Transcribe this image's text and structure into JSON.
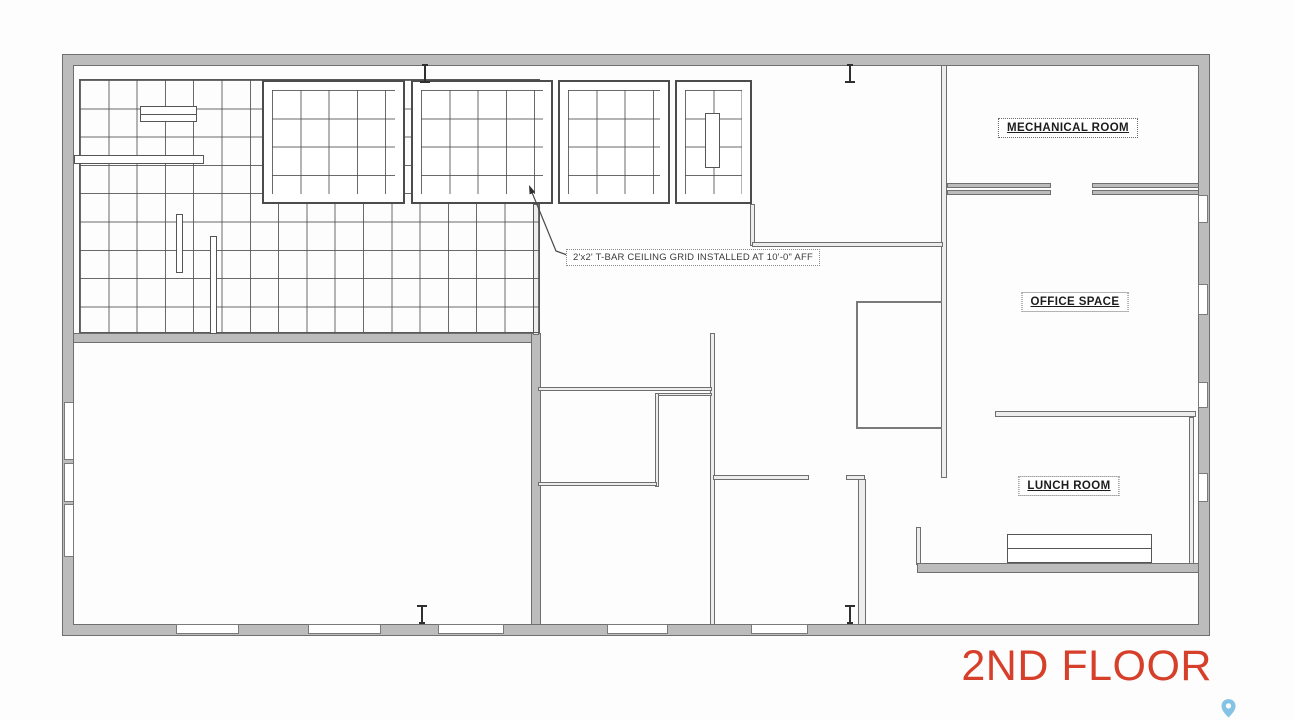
{
  "plan": {
    "title": "2ND FLOOR",
    "rooms": [
      {
        "label": "MECHANICAL ROOM"
      },
      {
        "label": "OFFICE SPACE"
      },
      {
        "label": "LUNCH ROOM"
      }
    ],
    "annotation": "2'x2' T-BAR CEILING GRID INSTALLED AT 10'-0\" AFF",
    "colors": {
      "title": "#d6402b",
      "wall_fill": "#bcbcbc",
      "wall_edge": "#6f6f6f",
      "grid_line": "#505050",
      "pin": "#85c3e6"
    },
    "icons": [
      {
        "name": "map-pin-icon"
      }
    ]
  }
}
